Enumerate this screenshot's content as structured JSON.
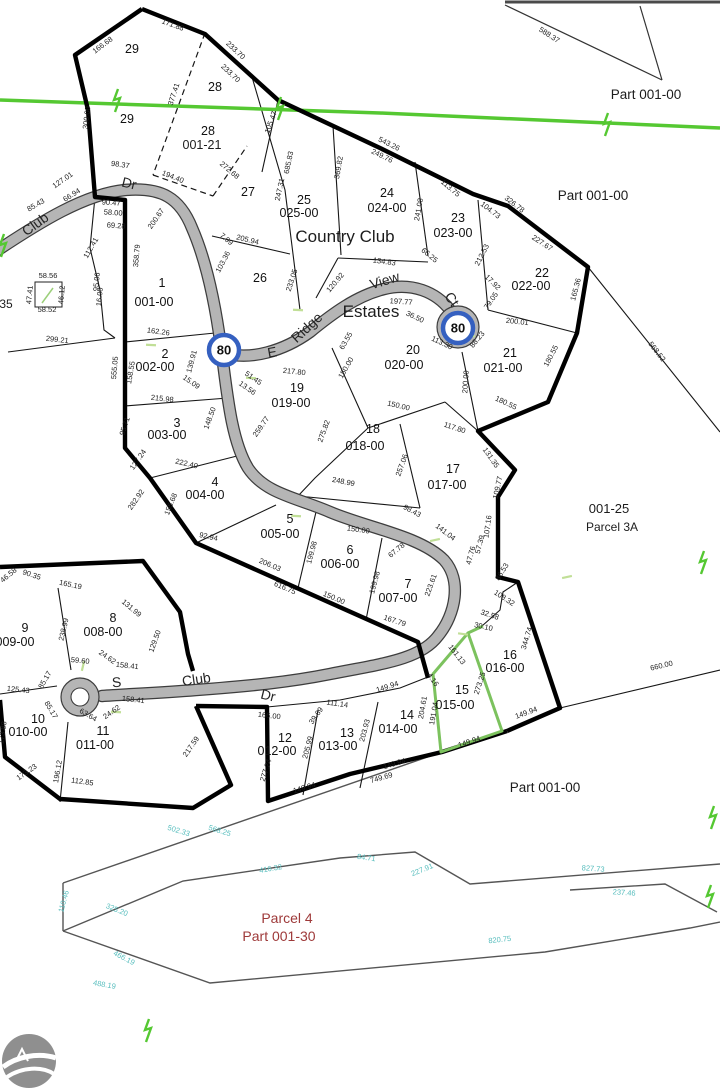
{
  "map": {
    "title": "plat-map",
    "colors": {
      "boundary": "#000000",
      "road_fill": "#b5b5b5",
      "road_casing": "#3d3d3d",
      "utility_green": "#55c832",
      "highlight_green": "#7cc25e",
      "tick_green": "#c1df97",
      "marker_blue": "#3560c0",
      "teal_dim": "#56bdbd",
      "red_text": "#9e3939",
      "logo_gray": "#8f8f8f"
    },
    "lots": [
      [
        "29",
        132,
        53
      ],
      [
        "29",
        127,
        123
      ],
      [
        "28",
        215,
        91
      ],
      [
        "28",
        208,
        135
      ],
      [
        "27",
        248,
        196
      ],
      [
        "26",
        260,
        282
      ],
      [
        "25",
        304,
        204,
        "025-00",
        299,
        217
      ],
      [
        "24",
        387,
        197,
        "024-00",
        387,
        212
      ],
      [
        "23",
        458,
        222,
        "023-00",
        453,
        237
      ],
      [
        "22",
        542,
        277,
        "022-00",
        531,
        290
      ],
      [
        "21",
        510,
        357,
        "021-00",
        503,
        372
      ],
      [
        "20",
        413,
        354,
        "020-00",
        404,
        369
      ],
      [
        "19",
        297,
        392,
        "019-00",
        291,
        407
      ],
      [
        "1",
        162,
        287,
        "001-00",
        154,
        306
      ],
      [
        "2",
        165,
        358,
        "002-00",
        155,
        371
      ],
      [
        "3",
        177,
        427,
        "003-00",
        167,
        439
      ],
      [
        "4",
        215,
        486,
        "004-00",
        205,
        499
      ],
      [
        "5",
        290,
        523,
        "005-00",
        280,
        538
      ],
      [
        "6",
        350,
        554,
        "006-00",
        340,
        568
      ],
      [
        "7",
        408,
        588,
        "007-00",
        398,
        602
      ],
      [
        "8",
        113,
        622,
        "008-00",
        103,
        636
      ],
      [
        "9",
        25,
        632,
        "009-00",
        15,
        646
      ],
      [
        "10",
        38,
        723,
        "010-00",
        28,
        736
      ],
      [
        "11",
        103,
        735,
        "011-00",
        95,
        749
      ],
      [
        "12",
        285,
        742,
        "012-00",
        277,
        755
      ],
      [
        "13",
        347,
        737,
        "013-00",
        338,
        750
      ],
      [
        "14",
        407,
        719,
        "014-00",
        398,
        733
      ],
      [
        "15",
        462,
        694,
        "015-00",
        455,
        709
      ],
      [
        "16",
        510,
        659,
        "016-00",
        505,
        672
      ],
      [
        "17",
        453,
        473,
        "017-00",
        447,
        489
      ],
      [
        "18",
        373,
        433,
        "018-00",
        365,
        450
      ]
    ],
    "dims": [
      [
        "166.68",
        104,
        47,
        -37
      ],
      [
        "171.88",
        172,
        27,
        20
      ],
      [
        "233.70",
        234,
        52,
        43
      ],
      [
        "233.70",
        229,
        75,
        43
      ],
      [
        "377.41",
        176,
        95,
        -72
      ],
      [
        "300.00",
        89,
        118,
        -83
      ],
      [
        "105.47",
        273,
        123,
        -70
      ],
      [
        "272.68",
        228,
        172,
        40
      ],
      [
        "543.26",
        388,
        146,
        26
      ],
      [
        "249.76",
        381,
        158,
        26
      ],
      [
        "113.75",
        449,
        190,
        40
      ],
      [
        "326.78",
        513,
        206,
        38
      ],
      [
        "104.73",
        489,
        212,
        38
      ],
      [
        "227.67",
        541,
        245,
        33
      ],
      [
        "241.08",
        421,
        210,
        -80
      ],
      [
        "212.53",
        484,
        256,
        -63
      ],
      [
        "165.36",
        578,
        290,
        -75
      ],
      [
        "17.92",
        491,
        284,
        45
      ],
      [
        "79.05",
        493,
        302,
        -55
      ],
      [
        "200.01",
        517,
        324,
        6
      ],
      [
        "88.23",
        479,
        341,
        -50
      ],
      [
        "113.30",
        441,
        345,
        25
      ],
      [
        "36.50",
        414,
        319,
        25
      ],
      [
        "200.00",
        468,
        382,
        -86
      ],
      [
        "180.55",
        553,
        357,
        -62
      ],
      [
        "180.55",
        505,
        405,
        25
      ],
      [
        "568.52",
        655,
        353,
        52
      ],
      [
        "588.37",
        548,
        37,
        33
      ],
      [
        "685.83",
        291,
        163,
        -78
      ],
      [
        "247.31",
        282,
        190,
        -78
      ],
      [
        "233.05",
        294,
        281,
        -72
      ],
      [
        "369.82",
        341,
        168,
        -80
      ],
      [
        "194.40",
        172,
        179,
        22
      ],
      [
        "98.37",
        120,
        167,
        8
      ],
      [
        "127.01",
        64,
        182,
        -35
      ],
      [
        "66.94",
        73,
        197,
        -32
      ],
      [
        "85.43",
        37,
        207,
        -30
      ],
      [
        "90.47",
        111,
        205,
        4
      ],
      [
        "58.00",
        113,
        215,
        4
      ],
      [
        "69.28",
        116,
        228,
        4
      ],
      [
        "200.67",
        158,
        220,
        -55
      ],
      [
        "205.94",
        247,
        242,
        14
      ],
      [
        "7.99",
        225,
        241,
        40
      ],
      [
        "103.36",
        225,
        263,
        -62
      ],
      [
        "358.79",
        139,
        256,
        -85
      ],
      [
        "112.41",
        93,
        249,
        -60
      ],
      [
        "95.06",
        99,
        282,
        -85,
        null,
        5.5
      ],
      [
        "16.00",
        102,
        297,
        -85,
        null,
        5.5
      ],
      [
        "299.21",
        57,
        342,
        6
      ],
      [
        "134.83",
        384,
        264,
        8
      ],
      [
        "120.92",
        337,
        284,
        -50
      ],
      [
        "66.25",
        428,
        257,
        40
      ],
      [
        "197.77",
        401,
        304,
        4
      ],
      [
        "162.26",
        158,
        334,
        8
      ],
      [
        "139.91",
        194,
        362,
        -75
      ],
      [
        "15.09",
        190,
        384,
        35
      ],
      [
        "215.98",
        162,
        401,
        6
      ],
      [
        "555.05",
        117,
        368,
        -85
      ],
      [
        "158.55",
        133,
        373,
        -80
      ],
      [
        "95.71",
        127,
        427,
        -72
      ],
      [
        "127.24",
        140,
        461,
        -55
      ],
      [
        "222.40",
        186,
        466,
        13
      ],
      [
        "148.50",
        212,
        419,
        -70
      ],
      [
        "282.92",
        138,
        501,
        -55
      ],
      [
        "155.68",
        173,
        505,
        -68
      ],
      [
        "92.94",
        208,
        539,
        12
      ],
      [
        "217.80",
        294,
        374,
        6
      ],
      [
        "51.45",
        252,
        380,
        35
      ],
      [
        "13.56",
        246,
        390,
        35
      ],
      [
        "63.55",
        348,
        342,
        -60
      ],
      [
        "150.00",
        348,
        369,
        -60
      ],
      [
        "259.77",
        263,
        428,
        -55
      ],
      [
        "275.82",
        326,
        432,
        -70
      ],
      [
        "150.00",
        398,
        408,
        13
      ],
      [
        "117.80",
        454,
        430,
        18
      ],
      [
        "257.06",
        404,
        466,
        -70
      ],
      [
        "248.99",
        343,
        484,
        11
      ],
      [
        "150.00",
        358,
        532,
        8
      ],
      [
        "199.98",
        314,
        553,
        -75
      ],
      [
        "199.98",
        377,
        583,
        -75
      ],
      [
        "206.03",
        269,
        567,
        23
      ],
      [
        "616.75",
        284,
        590,
        23
      ],
      [
        "150.00",
        333,
        600,
        23
      ],
      [
        "67.78",
        398,
        552,
        -40
      ],
      [
        "98.43",
        411,
        513,
        28
      ],
      [
        "141.04",
        444,
        534,
        38
      ],
      [
        "223.61",
        433,
        586,
        -70
      ],
      [
        "167.79",
        394,
        623,
        18
      ],
      [
        "131.35",
        489,
        459,
        55
      ],
      [
        "109.77",
        500,
        488,
        -78
      ],
      [
        "107.16",
        490,
        527,
        -82
      ],
      [
        "57.39",
        482,
        545,
        -75
      ],
      [
        "47.76",
        473,
        556,
        -75
      ],
      [
        "86.53",
        504,
        573,
        -58
      ],
      [
        "108.32",
        503,
        600,
        33
      ],
      [
        "344.74",
        529,
        639,
        -73
      ],
      [
        "32.58",
        489,
        617,
        18
      ],
      [
        "30.10",
        483,
        629,
        12
      ],
      [
        "161.13",
        455,
        656,
        52
      ],
      [
        "273.25",
        482,
        684,
        -72
      ],
      [
        "4.16",
        431,
        681,
        55
      ],
      [
        "204.61",
        425,
        708,
        -80
      ],
      [
        "191.04",
        436,
        714,
        -80
      ],
      [
        "166.00",
        269,
        718,
        6
      ],
      [
        "111.14",
        337,
        706,
        8
      ],
      [
        "39.69",
        318,
        717,
        -55
      ],
      [
        "203.93",
        367,
        731,
        -75
      ],
      [
        "205.99",
        310,
        748,
        -75
      ],
      [
        "277.24",
        268,
        771,
        -72
      ],
      [
        "149.94",
        388,
        689,
        -18
      ],
      [
        "149.94",
        305,
        790,
        -17
      ],
      [
        "149.94",
        395,
        766,
        -16
      ],
      [
        "749.69",
        382,
        780,
        -16
      ],
      [
        "149.94",
        470,
        744,
        -19
      ],
      [
        "149.94",
        527,
        715,
        -20
      ],
      [
        "660.00",
        662,
        668,
        -13
      ],
      [
        "90.35",
        31,
        577,
        18
      ],
      [
        "46.58",
        10,
        577,
        -40
      ],
      [
        "165.19",
        70,
        587,
        12
      ],
      [
        "131.99",
        130,
        610,
        40
      ],
      [
        "129.50",
        157,
        642,
        -70
      ],
      [
        "238.99",
        66,
        630,
        -77
      ],
      [
        "59.60",
        80,
        663,
        6
      ],
      [
        "24.62",
        106,
        659,
        35
      ],
      [
        "158.41",
        127,
        668,
        6
      ],
      [
        "85.17",
        47,
        681,
        -60
      ],
      [
        "125.43",
        18,
        692,
        6
      ],
      [
        "85.17",
        49,
        711,
        60
      ],
      [
        "63.64",
        87,
        717,
        30
      ],
      [
        "24.62",
        113,
        714,
        -35
      ],
      [
        "158.41",
        133,
        702,
        6
      ],
      [
        "173.88",
        5,
        733,
        -82
      ],
      [
        "196.12",
        60,
        772,
        -80
      ],
      [
        "173.23",
        28,
        774,
        -35
      ],
      [
        "112.85",
        82,
        784,
        8
      ],
      [
        "217.59",
        193,
        748,
        -55
      ],
      [
        "58.56",
        48,
        278,
        0,
        null,
        5.5
      ],
      [
        "47.41",
        32,
        295,
        -85,
        null,
        5.5
      ],
      [
        "46.12",
        64,
        295,
        -85,
        null,
        5.5
      ],
      [
        "58.52",
        47,
        312,
        0,
        null,
        5.5
      ],
      [
        "502.33",
        178,
        833,
        17,
        "t"
      ],
      [
        "568.25",
        219,
        833,
        17,
        "t"
      ],
      [
        "110.46",
        66,
        902,
        -75,
        "t"
      ],
      [
        "325.20",
        116,
        912,
        22,
        "t"
      ],
      [
        "466.19",
        123,
        960,
        28,
        "t"
      ],
      [
        "416.32",
        271,
        871,
        -10,
        "t"
      ],
      [
        "84.71",
        366,
        860,
        8,
        "t"
      ],
      [
        "227.91",
        423,
        872,
        -22,
        "t"
      ],
      [
        "827.73",
        593,
        871,
        4,
        "t"
      ],
      [
        "237.46",
        624,
        895,
        4,
        "t"
      ],
      [
        "820.75",
        500,
        942,
        -6,
        "t"
      ],
      [
        "488.19",
        104,
        987,
        10,
        "t"
      ]
    ],
    "road_labels": [
      [
        "Club",
        38,
        228,
        -36
      ],
      [
        "Dr",
        128,
        188,
        14
      ],
      [
        "E",
        273,
        357,
        -10
      ],
      [
        "Ridge",
        310,
        331,
        -43
      ],
      [
        "View",
        386,
        285,
        -17
      ],
      [
        "Ct",
        448,
        302,
        55
      ],
      [
        "S",
        117,
        687,
        -5
      ],
      [
        "Club",
        197,
        684,
        -8
      ],
      [
        "Dr",
        267,
        700,
        14
      ]
    ],
    "annotations": [
      [
        "Country Club",
        345,
        242,
        17
      ],
      [
        "Estates",
        371,
        317,
        17
      ],
      [
        "Part 001-00",
        646,
        99,
        13.5
      ],
      [
        "Part 001-00",
        593,
        200,
        13.5
      ],
      [
        "Part 001-00",
        545,
        792,
        13.5
      ],
      [
        "001-25",
        609,
        513,
        13
      ],
      [
        "Parcel 3A",
        612,
        531,
        12
      ],
      [
        "Parcel 4",
        287,
        923,
        14,
        "red"
      ],
      [
        "Part 001-30",
        279,
        941,
        14,
        "red"
      ],
      [
        "001-21",
        202,
        149,
        12.5
      ],
      [
        "35",
        6,
        308,
        12
      ]
    ],
    "markers": [
      {
        "label": "80",
        "x": 224,
        "y": 350
      },
      {
        "label": "80",
        "x": 458,
        "y": 328
      }
    ]
  }
}
